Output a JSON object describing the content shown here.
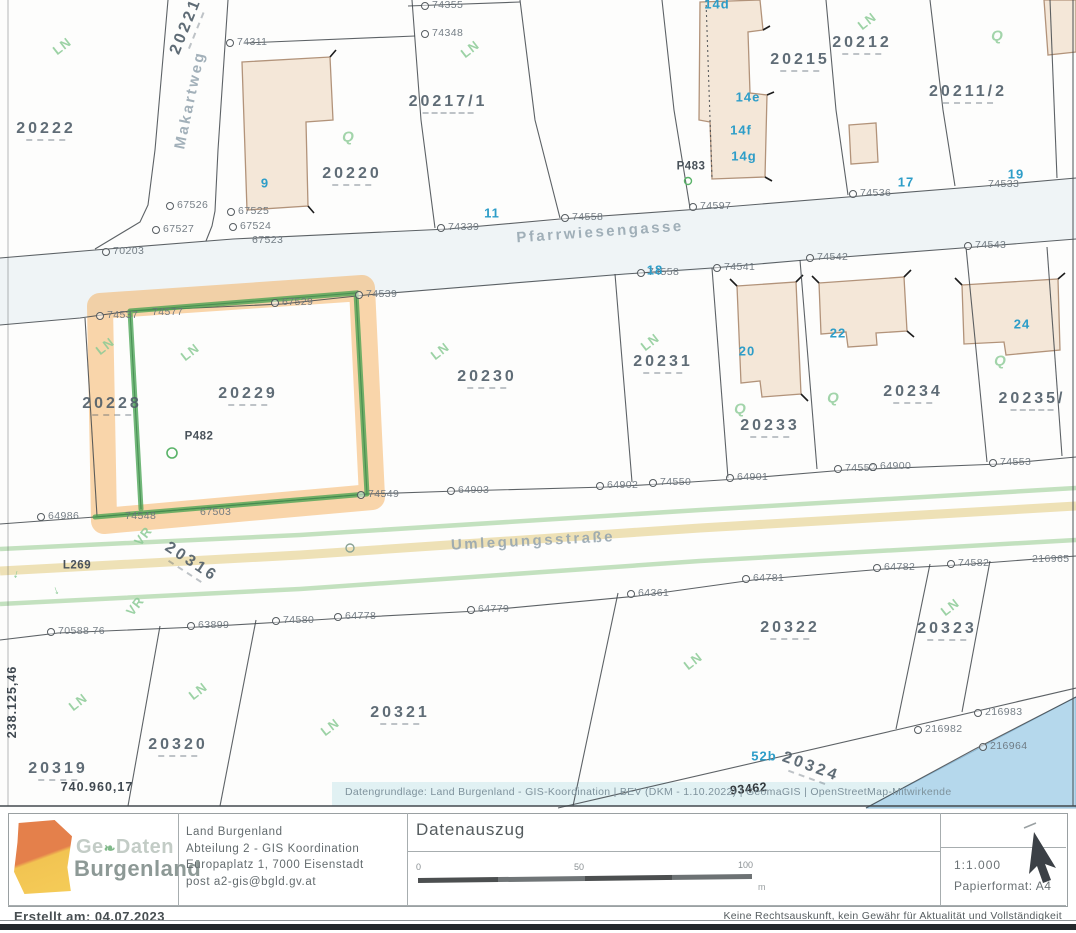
{
  "map": {
    "attribution": "Datengrundlage: Land Burgenland - GIS-Koordination | BEV (DKM - 1.10.2022) | GeomaGIS | OpenStreetMap-Mitwirkende",
    "labels": [
      {
        "t": "LN",
        "c": "veg",
        "x": 62,
        "y": 46,
        "r": -38
      },
      {
        "t": "LN",
        "c": "veg",
        "x": 470,
        "y": 49,
        "r": -38
      },
      {
        "t": "LN",
        "c": "veg",
        "x": 867,
        "y": 21,
        "r": -38
      },
      {
        "t": "LN",
        "c": "veg",
        "x": 105,
        "y": 346,
        "r": -38
      },
      {
        "t": "LN",
        "c": "veg",
        "x": 190,
        "y": 352,
        "r": -38
      },
      {
        "t": "LN",
        "c": "veg",
        "x": 440,
        "y": 351,
        "r": -38
      },
      {
        "t": "LN",
        "c": "veg",
        "x": 650,
        "y": 342,
        "r": -38
      },
      {
        "t": "LN",
        "c": "veg",
        "x": 950,
        "y": 607,
        "r": -38
      },
      {
        "t": "LN",
        "c": "veg",
        "x": 693,
        "y": 661,
        "r": -38
      },
      {
        "t": "LN",
        "c": "veg",
        "x": 78,
        "y": 702,
        "r": -38
      },
      {
        "t": "LN",
        "c": "veg",
        "x": 198,
        "y": 691,
        "r": -38
      },
      {
        "t": "LN",
        "c": "veg",
        "x": 330,
        "y": 727,
        "r": -38
      },
      {
        "t": "Q",
        "c": "vegq",
        "x": 348,
        "y": 137
      },
      {
        "t": "Q",
        "c": "vegq",
        "x": 997,
        "y": 36
      },
      {
        "t": "Q",
        "c": "vegq",
        "x": 740,
        "y": 409
      },
      {
        "t": "Q",
        "c": "vegq",
        "x": 833,
        "y": 398
      },
      {
        "t": "Q",
        "c": "vegq",
        "x": 1000,
        "y": 361
      },
      {
        "t": "VR",
        "c": "veg",
        "x": 143,
        "y": 536,
        "r": -52
      },
      {
        "t": "VR",
        "c": "veg",
        "x": 135,
        "y": 606,
        "r": -52
      },
      {
        "t": "→",
        "c": "vegarrow",
        "x": 18,
        "y": 575,
        "r": 105
      },
      {
        "t": "→",
        "c": "vegarrow",
        "x": 58,
        "y": 590,
        "r": 70
      },
      {
        "t": "74355",
        "c": "point",
        "x": 432,
        "y": 5
      },
      {
        "t": "74311",
        "c": "point",
        "x": 237,
        "y": 42
      },
      {
        "t": "74348",
        "c": "point",
        "x": 432,
        "y": 33
      },
      {
        "t": "67526",
        "c": "point",
        "x": 177,
        "y": 205
      },
      {
        "t": "67525",
        "c": "point",
        "x": 238,
        "y": 211
      },
      {
        "t": "67527",
        "c": "point",
        "x": 163,
        "y": 229
      },
      {
        "t": "67524",
        "c": "point",
        "x": 240,
        "y": 226
      },
      {
        "t": "67523",
        "c": "point",
        "x": 252,
        "y": 240,
        "dot": false
      },
      {
        "t": "70203",
        "c": "point",
        "x": 113,
        "y": 251
      },
      {
        "t": "74339",
        "c": "point",
        "x": 448,
        "y": 227
      },
      {
        "t": "74558",
        "c": "point",
        "x": 572,
        "y": 217
      },
      {
        "t": "74597",
        "c": "point",
        "x": 700,
        "y": 206
      },
      {
        "t": "74536",
        "c": "point",
        "x": 860,
        "y": 193
      },
      {
        "t": "74533",
        "c": "point",
        "x": 988,
        "y": 184,
        "dot": false
      },
      {
        "t": "74543",
        "c": "point",
        "x": 975,
        "y": 245
      },
      {
        "t": "74542",
        "c": "point",
        "x": 817,
        "y": 257
      },
      {
        "t": "74541",
        "c": "point",
        "x": 724,
        "y": 267
      },
      {
        "t": "74558",
        "c": "point",
        "x": 648,
        "y": 272
      },
      {
        "t": "74539",
        "c": "point",
        "x": 366,
        "y": 294
      },
      {
        "t": "67529",
        "c": "point",
        "x": 282,
        "y": 302
      },
      {
        "t": "74537",
        "c": "point",
        "x": 107,
        "y": 315
      },
      {
        "t": "74577",
        "c": "point",
        "x": 152,
        "y": 312,
        "dot": false
      },
      {
        "t": "64986",
        "c": "point",
        "x": 48,
        "y": 516
      },
      {
        "t": "74548",
        "c": "point",
        "x": 125,
        "y": 516,
        "dot": false
      },
      {
        "t": "67503",
        "c": "point",
        "x": 200,
        "y": 512,
        "dot": false
      },
      {
        "t": "74549",
        "c": "point",
        "x": 368,
        "y": 494
      },
      {
        "t": "64903",
        "c": "point",
        "x": 458,
        "y": 490
      },
      {
        "t": "64902",
        "c": "point",
        "x": 607,
        "y": 485
      },
      {
        "t": "74550",
        "c": "point",
        "x": 660,
        "y": 482
      },
      {
        "t": "64901",
        "c": "point",
        "x": 737,
        "y": 477
      },
      {
        "t": "74552",
        "c": "point",
        "x": 845,
        "y": 468
      },
      {
        "t": "64900",
        "c": "point",
        "x": 880,
        "y": 466
      },
      {
        "t": "74553",
        "c": "point",
        "x": 1000,
        "y": 462
      },
      {
        "t": "70588 76",
        "c": "point",
        "x": 58,
        "y": 631
      },
      {
        "t": "63899",
        "c": "point",
        "x": 198,
        "y": 625
      },
      {
        "t": "74580",
        "c": "point",
        "x": 283,
        "y": 620
      },
      {
        "t": "64778",
        "c": "point",
        "x": 345,
        "y": 616
      },
      {
        "t": "64779",
        "c": "point",
        "x": 478,
        "y": 609
      },
      {
        "t": "64361",
        "c": "point",
        "x": 638,
        "y": 593
      },
      {
        "t": "64781",
        "c": "point",
        "x": 753,
        "y": 578
      },
      {
        "t": "64782",
        "c": "point",
        "x": 884,
        "y": 567
      },
      {
        "t": "74582",
        "c": "point",
        "x": 958,
        "y": 563
      },
      {
        "t": "216965",
        "c": "point",
        "x": 1032,
        "y": 559,
        "dot": false
      },
      {
        "t": "216983",
        "c": "point",
        "x": 985,
        "y": 712
      },
      {
        "t": "216982",
        "c": "point",
        "x": 925,
        "y": 729
      },
      {
        "t": "216964",
        "c": "point",
        "x": 990,
        "y": 746
      },
      {
        "t": "93462",
        "c": "pointbold",
        "x": 730,
        "y": 789,
        "r": -6,
        "dot": false
      },
      {
        "t": "P483",
        "c": "pointdark",
        "x": 691,
        "y": 167
      },
      {
        "t": "P482",
        "c": "pointdark",
        "x": 199,
        "y": 437
      },
      {
        "t": "L269",
        "c": "pointdark",
        "x": 77,
        "y": 566
      },
      {
        "t": "238.125,46",
        "c": "coord",
        "x": 12,
        "y": 702,
        "r": -90
      },
      {
        "t": "740.960,17",
        "c": "coord",
        "x": 97,
        "y": 787
      },
      {
        "t": "20222",
        "c": "parcel",
        "x": 46,
        "y": 131
      },
      {
        "t": "20221",
        "c": "parcel",
        "x": 188,
        "y": 27,
        "r": -68
      },
      {
        "t": "20217/1",
        "c": "parcel",
        "x": 448,
        "y": 104
      },
      {
        "t": "20220",
        "c": "parcel",
        "x": 352,
        "y": 176
      },
      {
        "t": "20215",
        "c": "parcel",
        "x": 800,
        "y": 62
      },
      {
        "t": "20212",
        "c": "parcel",
        "x": 862,
        "y": 45
      },
      {
        "t": "20211/2",
        "c": "parcel",
        "x": 968,
        "y": 94
      },
      {
        "t": "20229",
        "c": "parcel",
        "x": 248,
        "y": 396
      },
      {
        "t": "20228",
        "c": "parcel",
        "x": 112,
        "y": 406
      },
      {
        "t": "20230",
        "c": "parcel",
        "x": 487,
        "y": 379
      },
      {
        "t": "20231",
        "c": "parcel",
        "x": 663,
        "y": 364
      },
      {
        "t": "20233",
        "c": "parcel",
        "x": 770,
        "y": 428
      },
      {
        "t": "20234",
        "c": "parcel",
        "x": 913,
        "y": 394
      },
      {
        "t": "20235/",
        "c": "parcel",
        "x": 1032,
        "y": 401
      },
      {
        "t": "20316",
        "c": "parcel",
        "x": 190,
        "y": 564,
        "r": 33
      },
      {
        "t": "20319",
        "c": "parcel",
        "x": 58,
        "y": 771
      },
      {
        "t": "20320",
        "c": "parcel",
        "x": 178,
        "y": 747
      },
      {
        "t": "20321",
        "c": "parcel",
        "x": 400,
        "y": 715
      },
      {
        "t": "20322",
        "c": "parcel",
        "x": 790,
        "y": 630
      },
      {
        "t": "20323",
        "c": "parcel",
        "x": 947,
        "y": 631
      },
      {
        "t": "20324",
        "c": "parcel",
        "x": 810,
        "y": 769,
        "r": 20
      },
      {
        "t": "Makartweg",
        "c": "street",
        "x": 190,
        "y": 100,
        "r": -78
      },
      {
        "t": "Pfarrwiesengasse",
        "c": "street",
        "x": 600,
        "y": 232,
        "r": -4
      },
      {
        "t": "Umlegungsstraße",
        "c": "street",
        "x": 533,
        "y": 541,
        "r": -3
      },
      {
        "t": "9",
        "c": "house",
        "x": 265,
        "y": 183
      },
      {
        "t": "11",
        "c": "house",
        "x": 492,
        "y": 213
      },
      {
        "t": "14d",
        "c": "house",
        "x": 717,
        "y": 4
      },
      {
        "t": "14e",
        "c": "house",
        "x": 748,
        "y": 97
      },
      {
        "t": "14f",
        "c": "house",
        "x": 741,
        "y": 130
      },
      {
        "t": "14g",
        "c": "house",
        "x": 744,
        "y": 156
      },
      {
        "t": "17",
        "c": "house",
        "x": 906,
        "y": 182
      },
      {
        "t": "18",
        "c": "house",
        "x": 655,
        "y": 270
      },
      {
        "t": "19",
        "c": "house",
        "x": 1016,
        "y": 174
      },
      {
        "t": "20",
        "c": "house",
        "x": 747,
        "y": 351
      },
      {
        "t": "22",
        "c": "house",
        "x": 838,
        "y": 333
      },
      {
        "t": "24",
        "c": "house",
        "x": 1022,
        "y": 324
      },
      {
        "t": "52b",
        "c": "house",
        "x": 764,
        "y": 756
      }
    ]
  },
  "footer": {
    "logo": {
      "text_top_left": "Ge",
      "leaf": "❧",
      "text_top_right": "Daten",
      "text_bottom": "Burgenland"
    },
    "address": [
      "Land Burgenland",
      "Abteilung 2 - GIS Koordination",
      "Europaplatz 1, 7000 Eisenstadt",
      "post a2-gis@bgld.gv.at"
    ],
    "title": "Datenauszug",
    "scale_ticks": [
      "0",
      "50",
      "100"
    ],
    "scale_unit": "m",
    "scale_ratio": "1:1.000",
    "paper": "Papierformat: A4",
    "created": "Erstellt am: 04.07.2023",
    "disclaimer": "Keine Rechtsauskunft, kein Gewähr für Aktualität und Vollständigkeit"
  },
  "colors": {
    "highlight_orange": "#f4a546",
    "highlight_green": "#43a04f",
    "house_number_blue": "#2d9dc8",
    "vegetation_green": "#8ccb96",
    "water_blue": "#b5d8ec"
  }
}
